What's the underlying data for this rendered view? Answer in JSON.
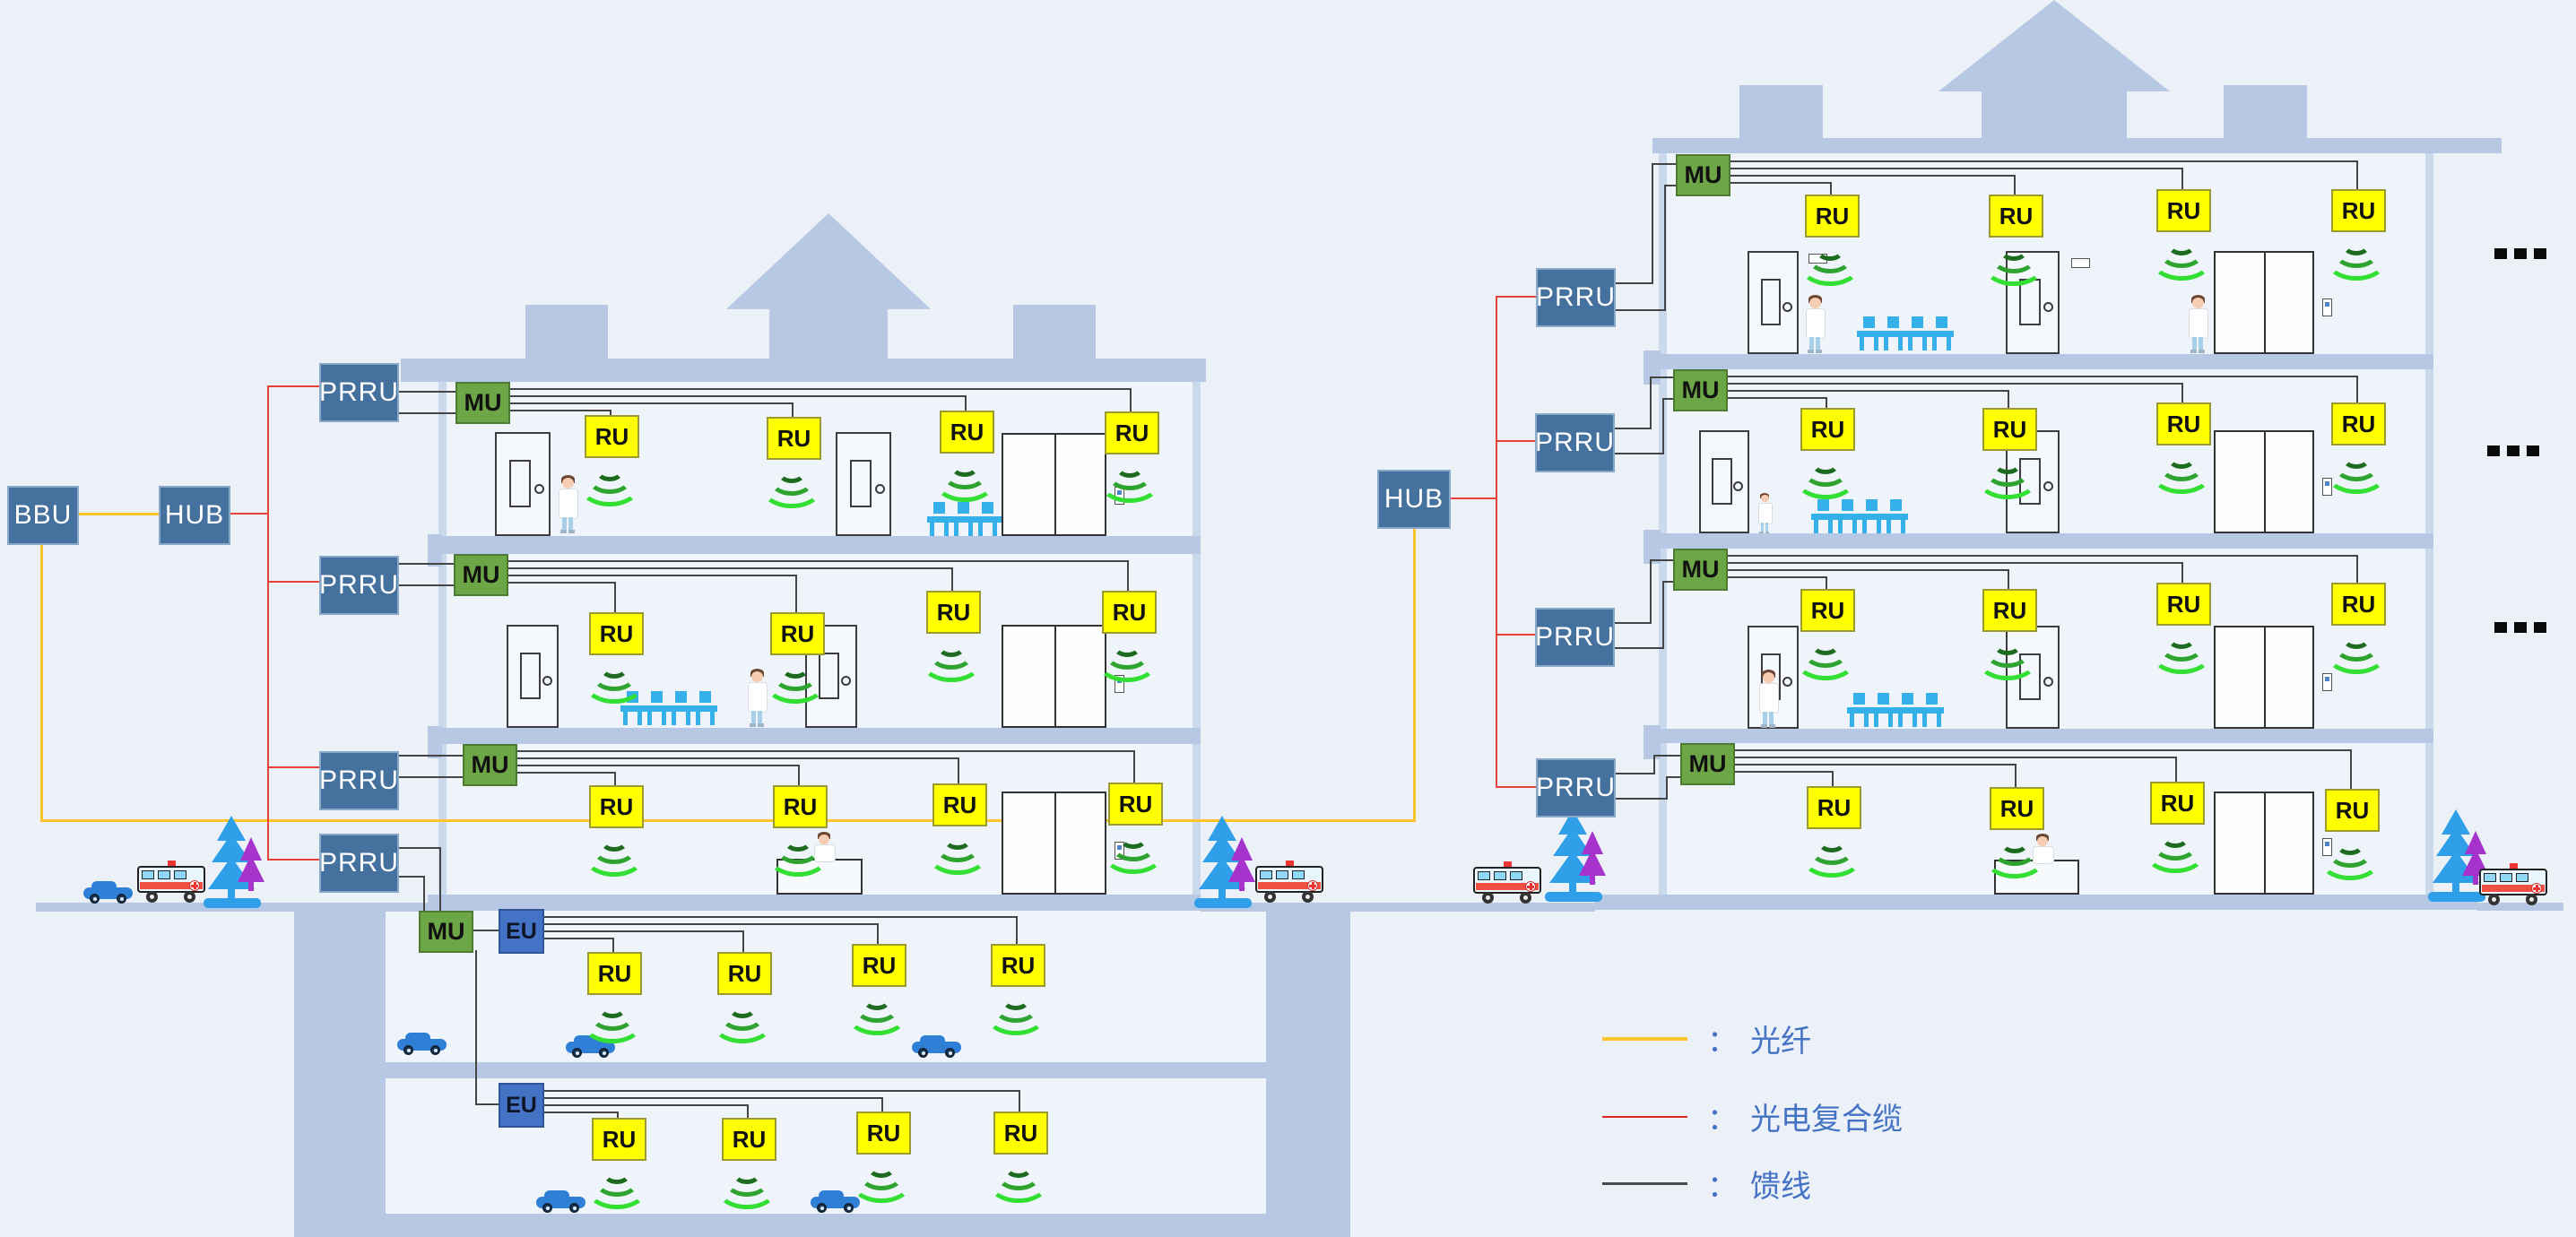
{
  "diagram": {
    "type": "indoor-distributed-antenna-network-architecture",
    "buildings": 2,
    "note_units": [
      "BBU",
      "HUB",
      "PRRU",
      "MU",
      "EU",
      "RU"
    ]
  },
  "labels": {
    "bbu": "BBU",
    "hub": "HUB",
    "prru": "PRRU",
    "mu": "MU",
    "eu": "EU",
    "ru": "RU"
  },
  "legend": {
    "colon": "：",
    "items": [
      {
        "name": "optical-fiber",
        "label": "光纤",
        "color": "#fdc32b",
        "thickness": 4
      },
      {
        "name": "opto-electric-composite-cable",
        "label": "光电复合缆",
        "color": "#d8281e",
        "thickness": 2
      },
      {
        "name": "feeder-line",
        "label": "馈线",
        "color": "#4a4a4a",
        "thickness": 3
      }
    ]
  },
  "ellipsis_more_floors": "...",
  "structure": {
    "left_building": {
      "above_ground_floors": 3,
      "basement_floors": 2,
      "prru_count": 4,
      "ru_per_floor": 4,
      "mu_per_floor": 1,
      "eu_count": 2
    },
    "right_building": {
      "floors_shown": 4,
      "prru_count": 4,
      "ru_per_floor": 4,
      "mu_per_floor": 1,
      "ellipsis_rows": 3
    }
  },
  "colors": {
    "background": "#ebf1f7",
    "building": "#b6c8e4",
    "wall": "#cbd9ec",
    "room": "#eef4fa",
    "unit_blue": "#45719e",
    "unit_blue_border": "#8aa9c9",
    "unit_green": "#6da647",
    "unit_green_border": "#4e7a33",
    "unit_eu": "#4472c4",
    "unit_eu_border": "#2f5597",
    "unit_ru": "#ffff00",
    "unit_ru_border": "#9a9a30",
    "fiber": "#fdc32b",
    "composite": "#e8423a",
    "feeder": "#454545",
    "legend_text": "#4472c4",
    "signal_arcs": [
      "#1c6b1e",
      "#2fa32f",
      "#33df33"
    ],
    "chair": "#35b1ea",
    "car": "#2f7fd6",
    "tree_blue": "#2e9fe8",
    "tree_purple": "#a633cc"
  }
}
